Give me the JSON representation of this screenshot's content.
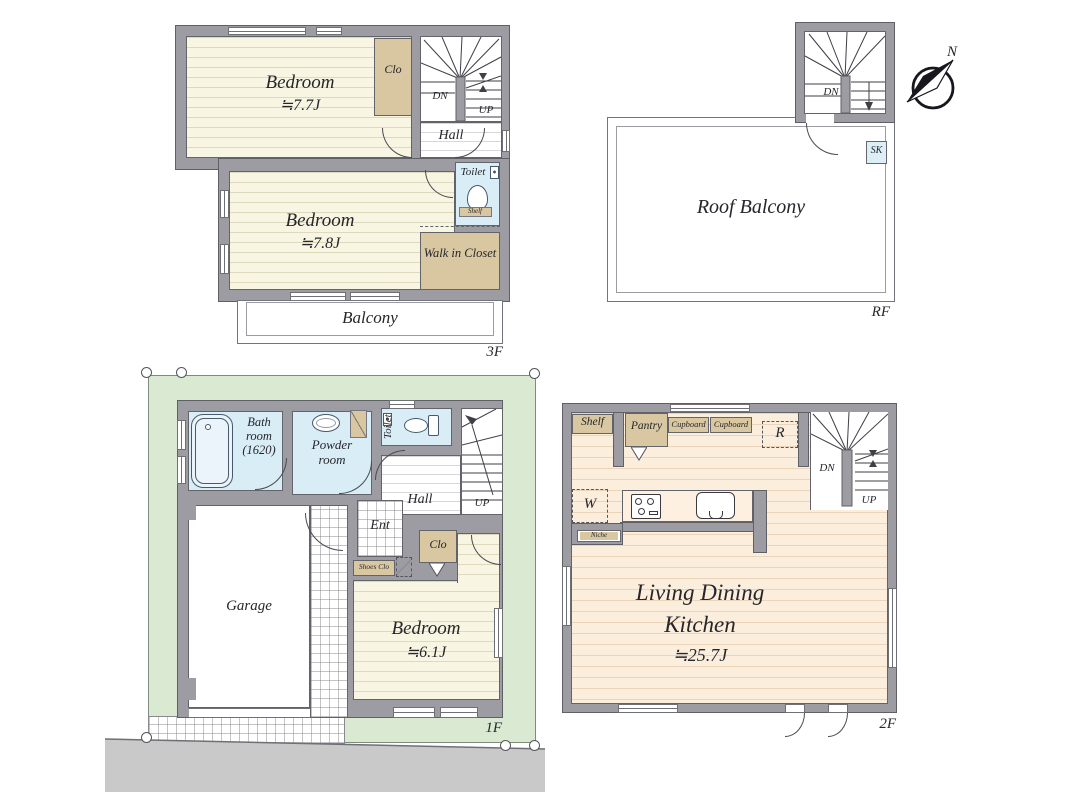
{
  "colors": {
    "wall": "#9c9ca2",
    "wall_outline": "#5f5f66",
    "floor_cream": "#f8f5e2",
    "floor_peach": "#fceedd",
    "wet_blue": "#d9edf6",
    "closet_tan": "#d8c7a0",
    "lot_green": "#d9e9d2",
    "road_gray": "#c9c9c9"
  },
  "f3": {
    "label": "3F",
    "bedroom1": "Bedroom",
    "bedroom1_size": "≒7.7J",
    "clo": "Clo",
    "dn": "DN",
    "up": "UP",
    "hall": "Hall",
    "toilet": "Toilet",
    "toilet_shelf": "Shelf",
    "bedroom2": "Bedroom",
    "bedroom2_size": "≒7.8J",
    "wic": "Walk in Closet",
    "balcony": "Balcony"
  },
  "rf": {
    "label": "RF",
    "dn": "DN",
    "roof_balcony": "Roof Balcony",
    "sk": "SK",
    "north": "N"
  },
  "f1": {
    "label": "1F",
    "bath": "Bath room (1620)",
    "powder": "Powder room",
    "toilet": "Toilet",
    "hall": "Hall",
    "up": "UP",
    "ent": "Ent",
    "shoes_clo": "Shoes Clo",
    "clo": "Clo",
    "garage": "Garage",
    "bedroom": "Bedroom",
    "bedroom_size": "≒6.1J"
  },
  "f2": {
    "label": "2F",
    "shelf": "Shelf",
    "pantry": "Pantry",
    "cupboard1": "Cupboard",
    "cupboard2": "Cupboard",
    "fridge": "R",
    "washer": "W",
    "niche": "Niche",
    "dn": "DN",
    "up": "UP",
    "ldk_line1": "Living Dining",
    "ldk_line2": "Kitchen",
    "ldk_size": "≒25.7J"
  }
}
